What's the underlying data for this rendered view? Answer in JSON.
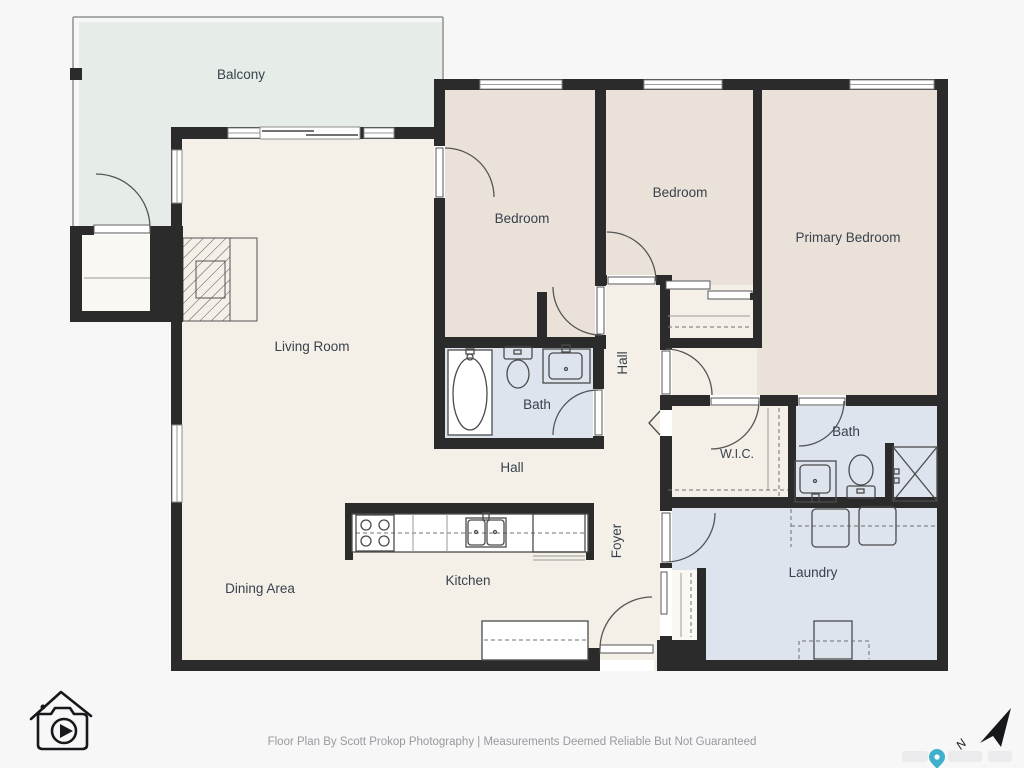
{
  "document": {
    "type": "residential-floor-plan",
    "description": "Single-level condo floor plan with balcony, three bedrooms, two baths, laundry"
  },
  "rooms": {
    "balcony": {
      "label": "Balcony"
    },
    "living_room": {
      "label": "Living Room"
    },
    "dining_area": {
      "label": "Dining Area"
    },
    "kitchen": {
      "label": "Kitchen"
    },
    "bedroom_left": {
      "label": "Bedroom"
    },
    "bedroom_middle": {
      "label": "Bedroom"
    },
    "primary_bedroom": {
      "label": "Primary Bedroom"
    },
    "bath_main": {
      "label": "Bath"
    },
    "bath_ensuite": {
      "label": "Bath"
    },
    "wic": {
      "label": "W.I.C."
    },
    "laundry": {
      "label": "Laundry"
    },
    "hall_lower": {
      "label": "Hall"
    },
    "hall_corridor": {
      "label": "Hall"
    },
    "foyer": {
      "label": "Foyer"
    }
  },
  "footer": {
    "credit": "Floor Plan By Scott Prokop Photography | Measurements Deemed Reliable But Not Guaranteed"
  },
  "compass": {
    "north_label": "N"
  },
  "icons": {
    "photographer_logo": "house-camera-logo-icon",
    "compass": "north-arrow-icon",
    "map_pin": "map-pin-icon",
    "fixtures": [
      "bathtub-icon",
      "toilet-icon",
      "sink-icon",
      "shower-icon",
      "stove-icon",
      "fridge-icon",
      "washer-icon",
      "dryer-icon",
      "water-heater-icon",
      "fireplace-icon"
    ]
  },
  "colors": {
    "background": "#f7f7f8",
    "wall": "#2b2b2b",
    "floor_main": "#f4f0e7",
    "floor_bedroom": "#eae2d9",
    "floor_wet": "#dde4ee",
    "floor_balcony": "#e6ede8",
    "label_text": "#39414d",
    "footer_text": "#97999d",
    "pin_accent": "#3fb0cb"
  }
}
